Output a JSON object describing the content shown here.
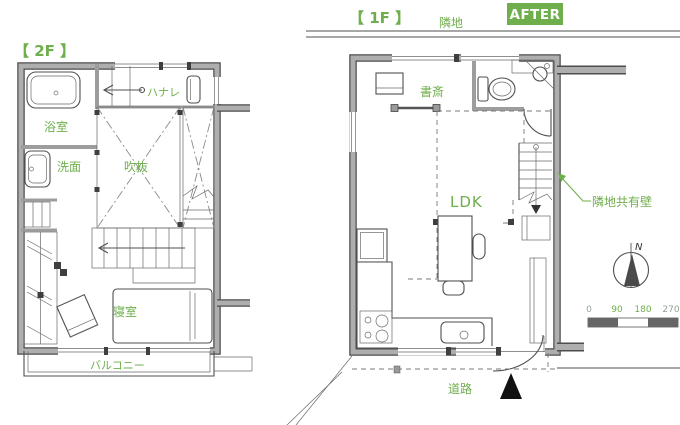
{
  "colors": {
    "accent_green": "#6fae4c",
    "wall_gray": "#aeaeae",
    "wall_outline": "#4d4d4d",
    "tick_gray": "#95a095",
    "entrance_marker": "#111111"
  },
  "header": {
    "after_badge": "AFTER"
  },
  "floor_2f": {
    "title": "【 2F 】",
    "rooms": {
      "bathroom": "浴室",
      "washroom": "洗面",
      "void": "吹抜",
      "hanare": "ハナレ",
      "bedroom": "寝室",
      "balcony": "バルコニー"
    }
  },
  "floor_1f": {
    "title": "【 1F 】",
    "adjacent_land": "隣地",
    "rooms": {
      "study": "書斎",
      "ldk": "LDK"
    },
    "annotations": {
      "shared_wall": "隣地共有壁",
      "road": "道路"
    }
  },
  "compass": {
    "north_label": "N"
  },
  "scale_bar": {
    "ticks": [
      "0",
      "90",
      "180",
      "270"
    ]
  }
}
